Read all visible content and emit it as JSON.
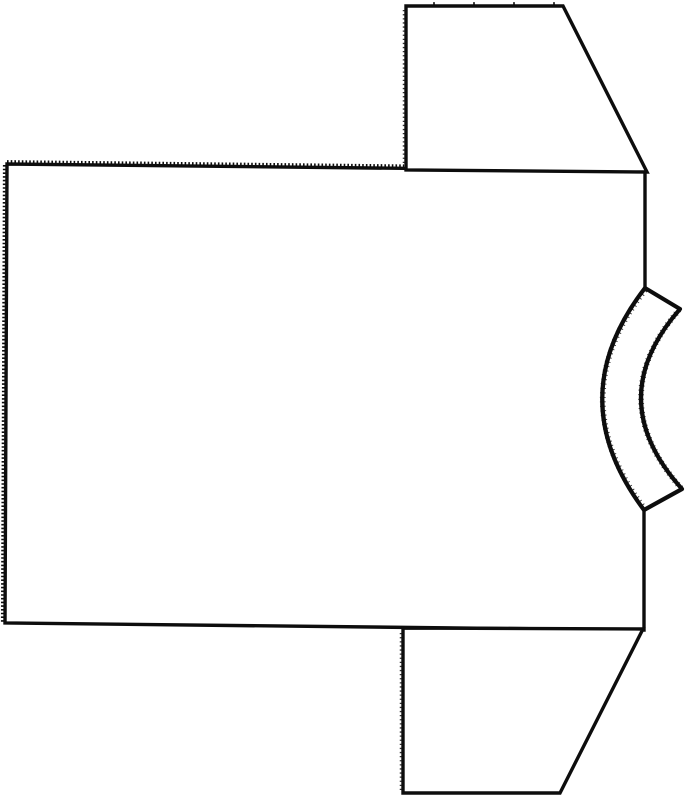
{
  "drawing": {
    "description": "Black-and-white line drawing of a short-sleeved T-shirt lying on its side: collar band at the right edge, serrated (pinked) hem along the left and top-left edges, one trapezoid sleeve at the top and one at the bottom",
    "background_color": "#ffffff",
    "stroke_color": "#0d0d0d",
    "canvas": {
      "width": 687,
      "height": 800,
      "viewbox": "0 0 687 800"
    },
    "shapes": {
      "body_panel": {
        "label": "shirt body panel",
        "d": "M 645 288 L 645 171 L 7 164 L 5 623 L 644 630 L 644 510"
      },
      "sleeve_top": {
        "label": "upper sleeve",
        "d": "M 406 170 L 406 6 L 563 6 L 647 172 Z"
      },
      "sleeve_bottom": {
        "label": "lower sleeve",
        "d": "M 403 628 L 403 793 L 560 793 L 643 629 Z"
      },
      "neckband": {
        "label": "curved collar band",
        "d": "M 645 288 Q 560 398 644 510 L 682 489 Q 601 399 680 309 Z"
      },
      "hem_serration_top": {
        "label": "pinked edge along top hem",
        "d": "M 7 161.4 L 404 165.7"
      },
      "hem_serration_left": {
        "label": "pinked edge along left hem",
        "d": "M 4.2 165 L 2.2 623"
      },
      "sleeve_top_fold_texture": {
        "label": "dotted fold edge of upper sleeve",
        "d": "M 403.6 10 L 403.6 166"
      },
      "sleeve_bottom_fold_texture": {
        "label": "dotted fold edge of lower sleeve",
        "d": "M 400.6 633 L 400.6 790"
      },
      "sleeve_cap_notches": {
        "label": "notch ticks on upper sleeve cap",
        "d": "M 433 3.4 L 565 3.4"
      },
      "neckband_outer_fuzz": {
        "label": "rough outer edge of collar band",
        "d": "M 645 290 Q 561 398 644 508"
      },
      "neckband_inner_fuzz": {
        "label": "rough inner edge of collar band",
        "d": "M 681 488 Q 602 399 679 310"
      }
    }
  }
}
